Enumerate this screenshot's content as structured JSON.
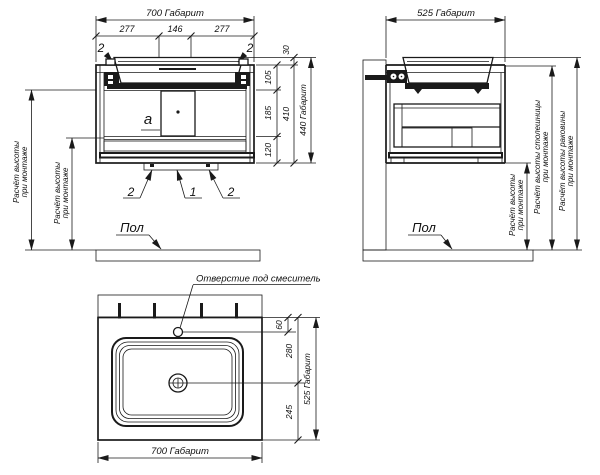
{
  "meta": {
    "background": "#ffffff",
    "ink": "#1a1a1a"
  },
  "front_view": {
    "dim_width_total": "700 Габарит",
    "dim_width_left": "277",
    "dim_width_center": "146",
    "dim_width_right": "277",
    "callout_bracket": "2",
    "callout_base": "1",
    "callout_panel": "a",
    "dim_rim": "30",
    "dim_top_section": "105",
    "dim_mid_section": "185",
    "dim_bottom_section": "120",
    "dim_body": "410",
    "dim_height_total": "440 Габарит",
    "mount_note_line1": "Расчёт высоты",
    "mount_note_line2": "при монтаже",
    "floor_label": "Пол"
  },
  "side_view": {
    "dim_width_total": "525 Габарит",
    "mount_note_line1": "Расчёт высоты",
    "mount_note_line2": "при монтаже",
    "counter_note_line1": "Расчёт высоты столешницы",
    "counter_note_line2": "при монтаже",
    "sink_note_line1": "Расчёт высоты раковины",
    "sink_note_line2": "при монтаже",
    "floor_label": "Пол"
  },
  "plan_view": {
    "faucet_hole_label": "Отверстие под смеситель",
    "dim_hole_offset": "60",
    "dim_drain_offset": "280",
    "dim_drain_to_edge": "245",
    "dim_depth_total": "525 Габарит",
    "dim_width_total": "700 Габарит"
  }
}
